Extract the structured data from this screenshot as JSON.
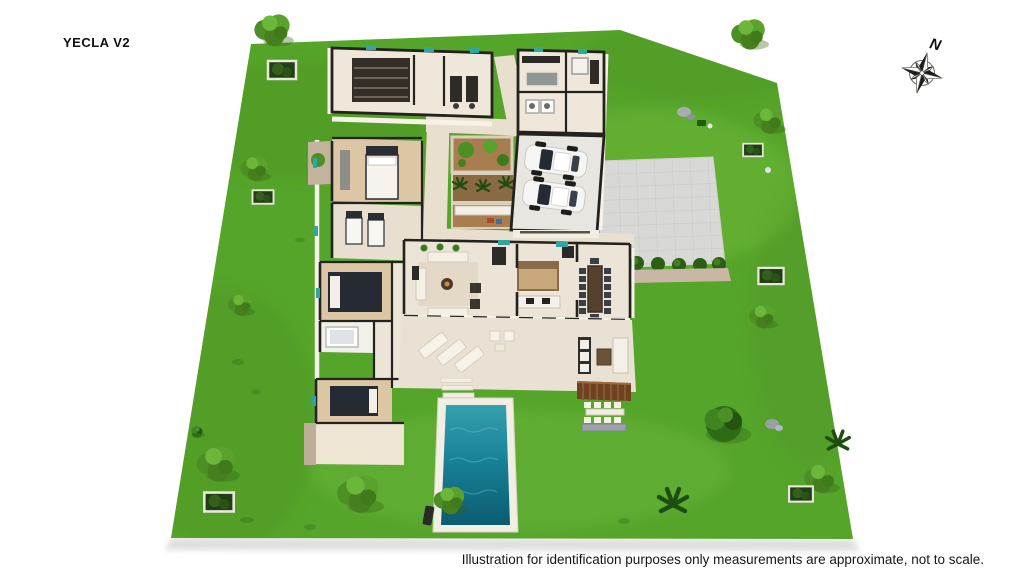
{
  "title": "YECLA V2",
  "compass": {
    "north_label": "N"
  },
  "disclaimer": "Illustration for identification purposes only measurements are approximate, not to scale.",
  "palette": {
    "background": "#ffffff",
    "grass": "#56a52b",
    "grass_shadow": "#3f8a1c",
    "grass_light": "#79c542",
    "pool_water": "#1d899b",
    "pool_water_deep": "#0c5f74",
    "pool_deck": "#f2eee3",
    "driveway": "#d8d8d6",
    "floor_cream": "#ece4d6",
    "floor_wood": "#dcc6a4",
    "wall_dark": "#23221e",
    "wall_light": "#f7f2e7",
    "courtyard_soil": "#a87e50",
    "pergola_roof": "#6e4120",
    "window_glass": "#2fa7a0",
    "text": "#111111"
  },
  "scene": {
    "type": "3d-floorplan-site-render",
    "features": [
      "lawn",
      "villa-floorplan",
      "double-garage-with-two-cars",
      "paved-driveway",
      "inner-courtyards",
      "swimming-pool",
      "sun-terrace-with-loungers",
      "pergola-dining",
      "garden-trees-and-planters",
      "compass-rose"
    ]
  }
}
